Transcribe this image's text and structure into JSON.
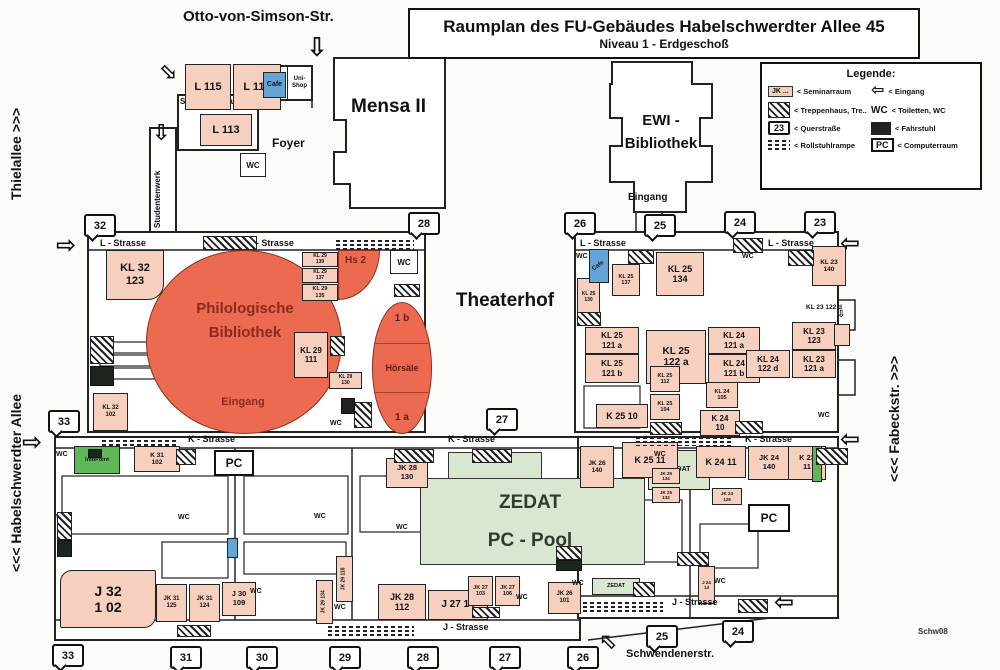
{
  "title": {
    "line1": "Raumplan des FU-Gebäudes Habelschwerdter Allee 45",
    "line2": "Niveau 1 - Erdgeschoß"
  },
  "legend": {
    "title": "Legende:",
    "seminar_key": "JK ...",
    "seminar_label": "< Seminarraum",
    "stairs_label": "< Treppenhaus, Tre..",
    "quer_key": "23",
    "quer_label": "< Querstraße",
    "ramp_label": "< Rollstuhlrampe",
    "entrance_label": "< Eingang",
    "wc_key": "WC",
    "wc_label": "< Toiletten, WC",
    "lift_label": "< Fahrstuhl",
    "pc_key": "PC",
    "pc_label": "< Computerraum"
  },
  "streets": {
    "otto": "Otto-von-Simson-Str.",
    "thielallee": "Thielallee  >>>",
    "habelschwerdter": "<<<  Habelschwerdter Allee",
    "fabeckstr": "<<<  Fabeckstr.  >>>",
    "schwendener": "Schwendenerstr."
  },
  "areas": {
    "mensa": "Mensa II",
    "ewi_line1": "EWI -",
    "ewi_line2": "Bibliothek",
    "ewi_eingang": "Eingang",
    "foyer": "Foyer",
    "seminarzentrum": "Seminarzentrum",
    "studentenwerk": "Studentenwerk",
    "theaterhof": "Theaterhof",
    "bib_line1": "Philologische",
    "bib_line2": "Bibliothek",
    "bib_eingang": "Eingang",
    "hs2": "Hs 2",
    "hoersaal_1b": "1 b",
    "hoersaal_mid": "Hörsäle",
    "hoersaal_1a": "1 a",
    "zedat_line1": "ZEDAT",
    "zedat_line2": "PC - Pool",
    "note": "Schw08"
  },
  "map": {
    "street_labels": [
      {
        "t": "L - Strasse",
        "x": 100,
        "y": 238
      },
      {
        "t": "L - Strasse",
        "x": 248,
        "y": 238
      },
      {
        "t": "L - Strasse",
        "x": 580,
        "y": 238
      },
      {
        "t": "L - Strasse",
        "x": 768,
        "y": 238
      },
      {
        "t": "K - Strasse",
        "x": 188,
        "y": 434
      },
      {
        "t": "K - Strasse",
        "x": 448,
        "y": 434
      },
      {
        "t": "K - Strasse",
        "x": 745,
        "y": 434
      },
      {
        "t": "J - Strasse",
        "x": 443,
        "y": 622
      },
      {
        "t": "J - Strasse",
        "x": 672,
        "y": 597
      }
    ],
    "rooms": [
      {
        "t": [
          "L 115"
        ],
        "x": 185,
        "y": 64,
        "w": 46,
        "h": 46,
        "fs": 11
      },
      {
        "t": [
          "L 116"
        ],
        "x": 233,
        "y": 64,
        "w": 48,
        "h": 46,
        "fs": 11
      },
      {
        "t": [
          "Cafe"
        ],
        "x": 263,
        "y": 72,
        "w": 23,
        "h": 26,
        "cls": "blue",
        "fs": 7
      },
      {
        "t": [
          "Uni-",
          "Shop"
        ],
        "x": 287,
        "y": 66,
        "w": 25,
        "h": 34,
        "cls": "white",
        "fs": 6
      },
      {
        "t": [
          "L 113"
        ],
        "x": 200,
        "y": 114,
        "w": 52,
        "h": 32,
        "fs": 11
      },
      {
        "t": [
          "KL 32",
          "123"
        ],
        "x": 106,
        "y": 250,
        "w": 58,
        "h": 50,
        "fs": 11,
        "round": "0 0 16px 0"
      },
      {
        "t": [
          "KL 29",
          "139"
        ],
        "x": 302,
        "y": 252,
        "w": 36,
        "h": 15,
        "fs": 5
      },
      {
        "t": [
          "KL 29",
          "137"
        ],
        "x": 302,
        "y": 268,
        "w": 36,
        "h": 15,
        "fs": 5
      },
      {
        "t": [
          "KL 29",
          "135"
        ],
        "x": 302,
        "y": 284,
        "w": 36,
        "h": 17,
        "fs": 5.5
      },
      {
        "t": [
          "KL 29",
          "111"
        ],
        "x": 294,
        "y": 332,
        "w": 34,
        "h": 46,
        "fs": 8
      },
      {
        "t": [
          "KL 29",
          "130"
        ],
        "x": 329,
        "y": 372,
        "w": 33,
        "h": 17,
        "fs": 5
      },
      {
        "t": [
          "KL 32",
          "102"
        ],
        "x": 93,
        "y": 393,
        "w": 35,
        "h": 38,
        "fs": 6
      },
      {
        "t": [
          "KL 25",
          "130"
        ],
        "x": 577,
        "y": 278,
        "w": 23,
        "h": 40,
        "fs": 5
      },
      {
        "t": [
          "Cafe"
        ],
        "x": 589,
        "y": 249,
        "w": 20,
        "h": 34,
        "cls": "blue",
        "fs": 6,
        "rot": -35
      },
      {
        "t": [
          "KL 25",
          "137"
        ],
        "x": 612,
        "y": 264,
        "w": 28,
        "h": 32,
        "fs": 5.5
      },
      {
        "t": [
          "KL 25",
          "134"
        ],
        "x": 656,
        "y": 252,
        "w": 48,
        "h": 44,
        "fs": 9
      },
      {
        "t": [
          "KL 25",
          "121 a"
        ],
        "x": 585,
        "y": 327,
        "w": 54,
        "h": 27,
        "fs": 8
      },
      {
        "t": [
          "KL 25",
          "121 b"
        ],
        "x": 585,
        "y": 354,
        "w": 54,
        "h": 29,
        "fs": 8
      },
      {
        "t": [
          "KL 25",
          "122 a"
        ],
        "x": 646,
        "y": 330,
        "w": 60,
        "h": 54,
        "fs": 10
      },
      {
        "t": [
          "KL 24",
          "121 a"
        ],
        "x": 708,
        "y": 327,
        "w": 52,
        "h": 27,
        "fs": 8
      },
      {
        "t": [
          "KL 24",
          "121 b"
        ],
        "x": 708,
        "y": 354,
        "w": 52,
        "h": 29,
        "fs": 8
      },
      {
        "t": [
          "KL 23",
          "123"
        ],
        "x": 792,
        "y": 322,
        "w": 44,
        "h": 28,
        "fs": 8
      },
      {
        "t": [
          "KL 24",
          "122 d"
        ],
        "x": 746,
        "y": 350,
        "w": 44,
        "h": 28,
        "fs": 8
      },
      {
        "t": [
          "KL 23",
          "121 a"
        ],
        "x": 792,
        "y": 350,
        "w": 44,
        "h": 28,
        "fs": 8
      },
      {
        "t": [
          "KL 25",
          "112"
        ],
        "x": 650,
        "y": 366,
        "w": 30,
        "h": 26,
        "fs": 5.5
      },
      {
        "t": [
          "KL 25",
          "104"
        ],
        "x": 650,
        "y": 394,
        "w": 30,
        "h": 26,
        "fs": 5.5
      },
      {
        "t": [
          "K 25 10"
        ],
        "x": 596,
        "y": 404,
        "w": 52,
        "h": 24,
        "fs": 9
      },
      {
        "t": [
          "KL 24",
          "105"
        ],
        "x": 706,
        "y": 382,
        "w": 32,
        "h": 26,
        "fs": 5.5
      },
      {
        "t": [
          "K 24",
          "10"
        ],
        "x": 700,
        "y": 410,
        "w": 40,
        "h": 26,
        "fs": 8
      },
      {
        "t": [
          "KL 23",
          "140"
        ],
        "x": 812,
        "y": 246,
        "w": 34,
        "h": 40,
        "fs": 6.5
      },
      {
        "t": [],
        "x": 834,
        "y": 324,
        "w": 16,
        "h": 22
      },
      {
        "t": [
          "K 31",
          "102"
        ],
        "x": 134,
        "y": 446,
        "w": 46,
        "h": 26,
        "fs": 6.5
      },
      {
        "t": [
          "InfoPoint"
        ],
        "x": 74,
        "y": 446,
        "w": 46,
        "h": 28,
        "cls": "greenb",
        "fs": 5.5
      },
      {
        "t": [
          "J  32",
          "1 02"
        ],
        "x": 60,
        "y": 570,
        "w": 96,
        "h": 58,
        "fs": 14,
        "round": "12px 2px 12px 2px"
      },
      {
        "t": [
          "JK 31",
          "125"
        ],
        "x": 156,
        "y": 584,
        "w": 31,
        "h": 38,
        "fs": 6
      },
      {
        "t": [
          "JK 31",
          "124"
        ],
        "x": 189,
        "y": 584,
        "w": 31,
        "h": 38,
        "fs": 6
      },
      {
        "t": [
          "J 30",
          "109"
        ],
        "x": 222,
        "y": 582,
        "w": 34,
        "h": 34,
        "fs": 7.5
      },
      {
        "t": [
          "JK 29 134"
        ],
        "x": 316,
        "y": 580,
        "w": 17,
        "h": 44,
        "fs": 5,
        "vert": true
      },
      {
        "t": [
          "JK 29 118"
        ],
        "x": 336,
        "y": 556,
        "w": 17,
        "h": 46,
        "fs": 5,
        "vert": true
      },
      {
        "t": [
          "JK 28",
          "130"
        ],
        "x": 386,
        "y": 458,
        "w": 42,
        "h": 30,
        "fs": 7.5
      },
      {
        "t": [
          "JK 28",
          "112"
        ],
        "x": 378,
        "y": 584,
        "w": 48,
        "h": 36,
        "fs": 9
      },
      {
        "t": [
          "J 27 14"
        ],
        "x": 428,
        "y": 590,
        "w": 60,
        "h": 30,
        "fs": 10
      },
      {
        "t": [
          "JK 27",
          "103"
        ],
        "x": 468,
        "y": 576,
        "w": 25,
        "h": 30,
        "fs": 5.5
      },
      {
        "t": [
          "JK 27",
          "106"
        ],
        "x": 495,
        "y": 576,
        "w": 25,
        "h": 30,
        "fs": 5.5
      },
      {
        "t": [
          "JK 26",
          "101"
        ],
        "x": 548,
        "y": 582,
        "w": 33,
        "h": 32,
        "fs": 6
      },
      {
        "t": [
          "ZEDAT"
        ],
        "x": 648,
        "y": 450,
        "w": 62,
        "h": 40,
        "cls": "green",
        "fs": 7
      },
      {
        "t": [
          "JK 26",
          "140"
        ],
        "x": 580,
        "y": 446,
        "w": 34,
        "h": 42,
        "fs": 6.5
      },
      {
        "t": [
          "K 25 11"
        ],
        "x": 622,
        "y": 442,
        "w": 56,
        "h": 36,
        "fs": 9
      },
      {
        "t": [
          "JK 25",
          "134"
        ],
        "x": 652,
        "y": 468,
        "w": 28,
        "h": 16,
        "fs": 4.5
      },
      {
        "t": [
          "JK 25",
          "132"
        ],
        "x": 652,
        "y": 487,
        "w": 28,
        "h": 16,
        "fs": 4.5
      },
      {
        "t": [
          "K 24 11"
        ],
        "x": 696,
        "y": 446,
        "w": 50,
        "h": 32,
        "fs": 9
      },
      {
        "t": [
          "JK 24",
          "140"
        ],
        "x": 748,
        "y": 446,
        "w": 42,
        "h": 34,
        "fs": 7.5
      },
      {
        "t": [
          "K 23",
          "11"
        ],
        "x": 788,
        "y": 446,
        "w": 38,
        "h": 34,
        "fs": 7.5
      },
      {
        "t": [],
        "x": 812,
        "y": 446,
        "w": 10,
        "h": 36,
        "cls": "greenb"
      },
      {
        "t": [
          "JK 24",
          "129"
        ],
        "x": 712,
        "y": 488,
        "w": 30,
        "h": 17,
        "fs": 4.5
      },
      {
        "t": [
          "J 24",
          "14"
        ],
        "x": 698,
        "y": 566,
        "w": 17,
        "h": 38,
        "fs": 4.5
      },
      {
        "t": [
          "ZEDAT"
        ],
        "x": 592,
        "y": 578,
        "w": 48,
        "h": 17,
        "cls": "green",
        "fs": 5.5
      },
      {
        "t": [],
        "x": 227,
        "y": 538,
        "w": 11,
        "h": 20,
        "cls": "blue"
      }
    ],
    "badges": [
      {
        "t": "32",
        "x": 84,
        "y": 214
      },
      {
        "t": "28",
        "x": 408,
        "y": 212
      },
      {
        "t": "26",
        "x": 564,
        "y": 212
      },
      {
        "t": "25",
        "x": 644,
        "y": 214
      },
      {
        "t": "24",
        "x": 724,
        "y": 211
      },
      {
        "t": "23",
        "x": 804,
        "y": 211
      },
      {
        "t": "33",
        "x": 48,
        "y": 410
      },
      {
        "t": "27",
        "x": 486,
        "y": 408
      },
      {
        "t": "33",
        "x": 52,
        "y": 644
      },
      {
        "t": "31",
        "x": 170,
        "y": 646
      },
      {
        "t": "30",
        "x": 246,
        "y": 646
      },
      {
        "t": "29",
        "x": 329,
        "y": 646
      },
      {
        "t": "28",
        "x": 407,
        "y": 646
      },
      {
        "t": "27",
        "x": 489,
        "y": 646
      },
      {
        "t": "26",
        "x": 567,
        "y": 646
      },
      {
        "t": "25",
        "x": 646,
        "y": 625
      },
      {
        "t": "24",
        "x": 722,
        "y": 620
      }
    ],
    "wc_labels": [
      {
        "x": 330,
        "y": 420
      },
      {
        "x": 576,
        "y": 253
      },
      {
        "x": 742,
        "y": 253
      },
      {
        "x": 818,
        "y": 412
      },
      {
        "x": 56,
        "y": 451
      },
      {
        "x": 56,
        "y": 514
      },
      {
        "x": 178,
        "y": 514
      },
      {
        "x": 314,
        "y": 513
      },
      {
        "x": 250,
        "y": 588
      },
      {
        "x": 334,
        "y": 604
      },
      {
        "x": 396,
        "y": 524
      },
      {
        "x": 498,
        "y": 451
      },
      {
        "x": 516,
        "y": 594
      },
      {
        "x": 654,
        "y": 451
      },
      {
        "x": 572,
        "y": 580
      },
      {
        "x": 714,
        "y": 578
      }
    ],
    "wc_boxes": [
      {
        "x": 390,
        "y": 250,
        "w": 26,
        "h": 22
      },
      {
        "x": 240,
        "y": 153,
        "w": 24,
        "h": 22
      }
    ],
    "pc_labels": [
      {
        "x": 214,
        "y": 450,
        "w": 36,
        "h": 22
      },
      {
        "x": 748,
        "y": 504,
        "w": 38,
        "h": 24
      }
    ],
    "stairs": [
      {
        "x": 203,
        "y": 236,
        "w": 52,
        "h": 12
      },
      {
        "x": 733,
        "y": 238,
        "w": 28,
        "h": 13
      },
      {
        "x": 90,
        "y": 336,
        "w": 22,
        "h": 26
      },
      {
        "x": 330,
        "y": 336,
        "w": 13,
        "h": 18
      },
      {
        "x": 354,
        "y": 402,
        "w": 16,
        "h": 24
      },
      {
        "x": 394,
        "y": 284,
        "w": 24,
        "h": 11
      },
      {
        "x": 628,
        "y": 250,
        "w": 24,
        "h": 12
      },
      {
        "x": 577,
        "y": 312,
        "w": 22,
        "h": 12
      },
      {
        "x": 650,
        "y": 422,
        "w": 30,
        "h": 11
      },
      {
        "x": 735,
        "y": 421,
        "w": 26,
        "h": 11
      },
      {
        "x": 788,
        "y": 250,
        "w": 24,
        "h": 14
      },
      {
        "x": 176,
        "y": 449,
        "w": 18,
        "h": 14
      },
      {
        "x": 394,
        "y": 449,
        "w": 38,
        "h": 12
      },
      {
        "x": 472,
        "y": 449,
        "w": 38,
        "h": 12
      },
      {
        "x": 556,
        "y": 546,
        "w": 24,
        "h": 12
      },
      {
        "x": 177,
        "y": 625,
        "w": 32,
        "h": 10
      },
      {
        "x": 472,
        "y": 607,
        "w": 26,
        "h": 9
      },
      {
        "x": 633,
        "y": 582,
        "w": 20,
        "h": 13
      },
      {
        "x": 816,
        "y": 448,
        "w": 30,
        "h": 15
      },
      {
        "x": 738,
        "y": 599,
        "w": 28,
        "h": 12
      },
      {
        "x": 57,
        "y": 512,
        "w": 13,
        "h": 26
      },
      {
        "x": 677,
        "y": 552,
        "w": 30,
        "h": 12
      }
    ],
    "lifts": [
      {
        "x": 90,
        "y": 366,
        "w": 22,
        "h": 18
      },
      {
        "x": 341,
        "y": 398,
        "w": 12,
        "h": 14
      },
      {
        "x": 57,
        "y": 540,
        "w": 13,
        "h": 15
      },
      {
        "x": 88,
        "y": 449,
        "w": 12,
        "h": 7
      },
      {
        "x": 556,
        "y": 560,
        "w": 24,
        "h": 9
      }
    ],
    "ramps": [
      {
        "x": 336,
        "y": 240,
        "w": 78,
        "h": 11
      },
      {
        "x": 102,
        "y": 436,
        "w": 74,
        "h": 10
      },
      {
        "x": 636,
        "y": 437,
        "w": 96,
        "h": 9
      },
      {
        "x": 328,
        "y": 626,
        "w": 86,
        "h": 10
      },
      {
        "x": 583,
        "y": 602,
        "w": 80,
        "h": 10
      }
    ],
    "arrows": [
      {
        "d": "down",
        "x": 306,
        "y": 34,
        "s": 26
      },
      {
        "d": "down",
        "x": 152,
        "y": 122,
        "s": 22
      },
      {
        "d": "down",
        "x": 160,
        "y": 62,
        "s": 22,
        "rot": -45
      },
      {
        "d": "right",
        "x": 56,
        "y": 234,
        "s": 24
      },
      {
        "d": "left",
        "x": 840,
        "y": 232,
        "s": 24
      },
      {
        "d": "right",
        "x": 22,
        "y": 431,
        "s": 24
      },
      {
        "d": "left",
        "x": 840,
        "y": 428,
        "s": 24
      },
      {
        "d": "left",
        "x": 774,
        "y": 591,
        "s": 24
      },
      {
        "d": "down",
        "x": 598,
        "y": 630,
        "s": 22,
        "rot": 135
      },
      {
        "d": "down",
        "x": 837,
        "y": 310,
        "s": 10
      }
    ],
    "misc_labels": [
      {
        "t": "KL 23 122 d",
        "x": 806,
        "y": 304,
        "fs": 6.5
      },
      {
        "t": "Schw08",
        "x": 918,
        "y": 627,
        "fs": 8
      }
    ]
  },
  "colors": {
    "room_peach": "#f6cfbe",
    "library_red": "#ec6a50",
    "zedat_green": "#d9e7d0",
    "info_green": "#5fb857",
    "cafe_blue": "#64a5d8",
    "lift_dark": "#1c241c"
  }
}
